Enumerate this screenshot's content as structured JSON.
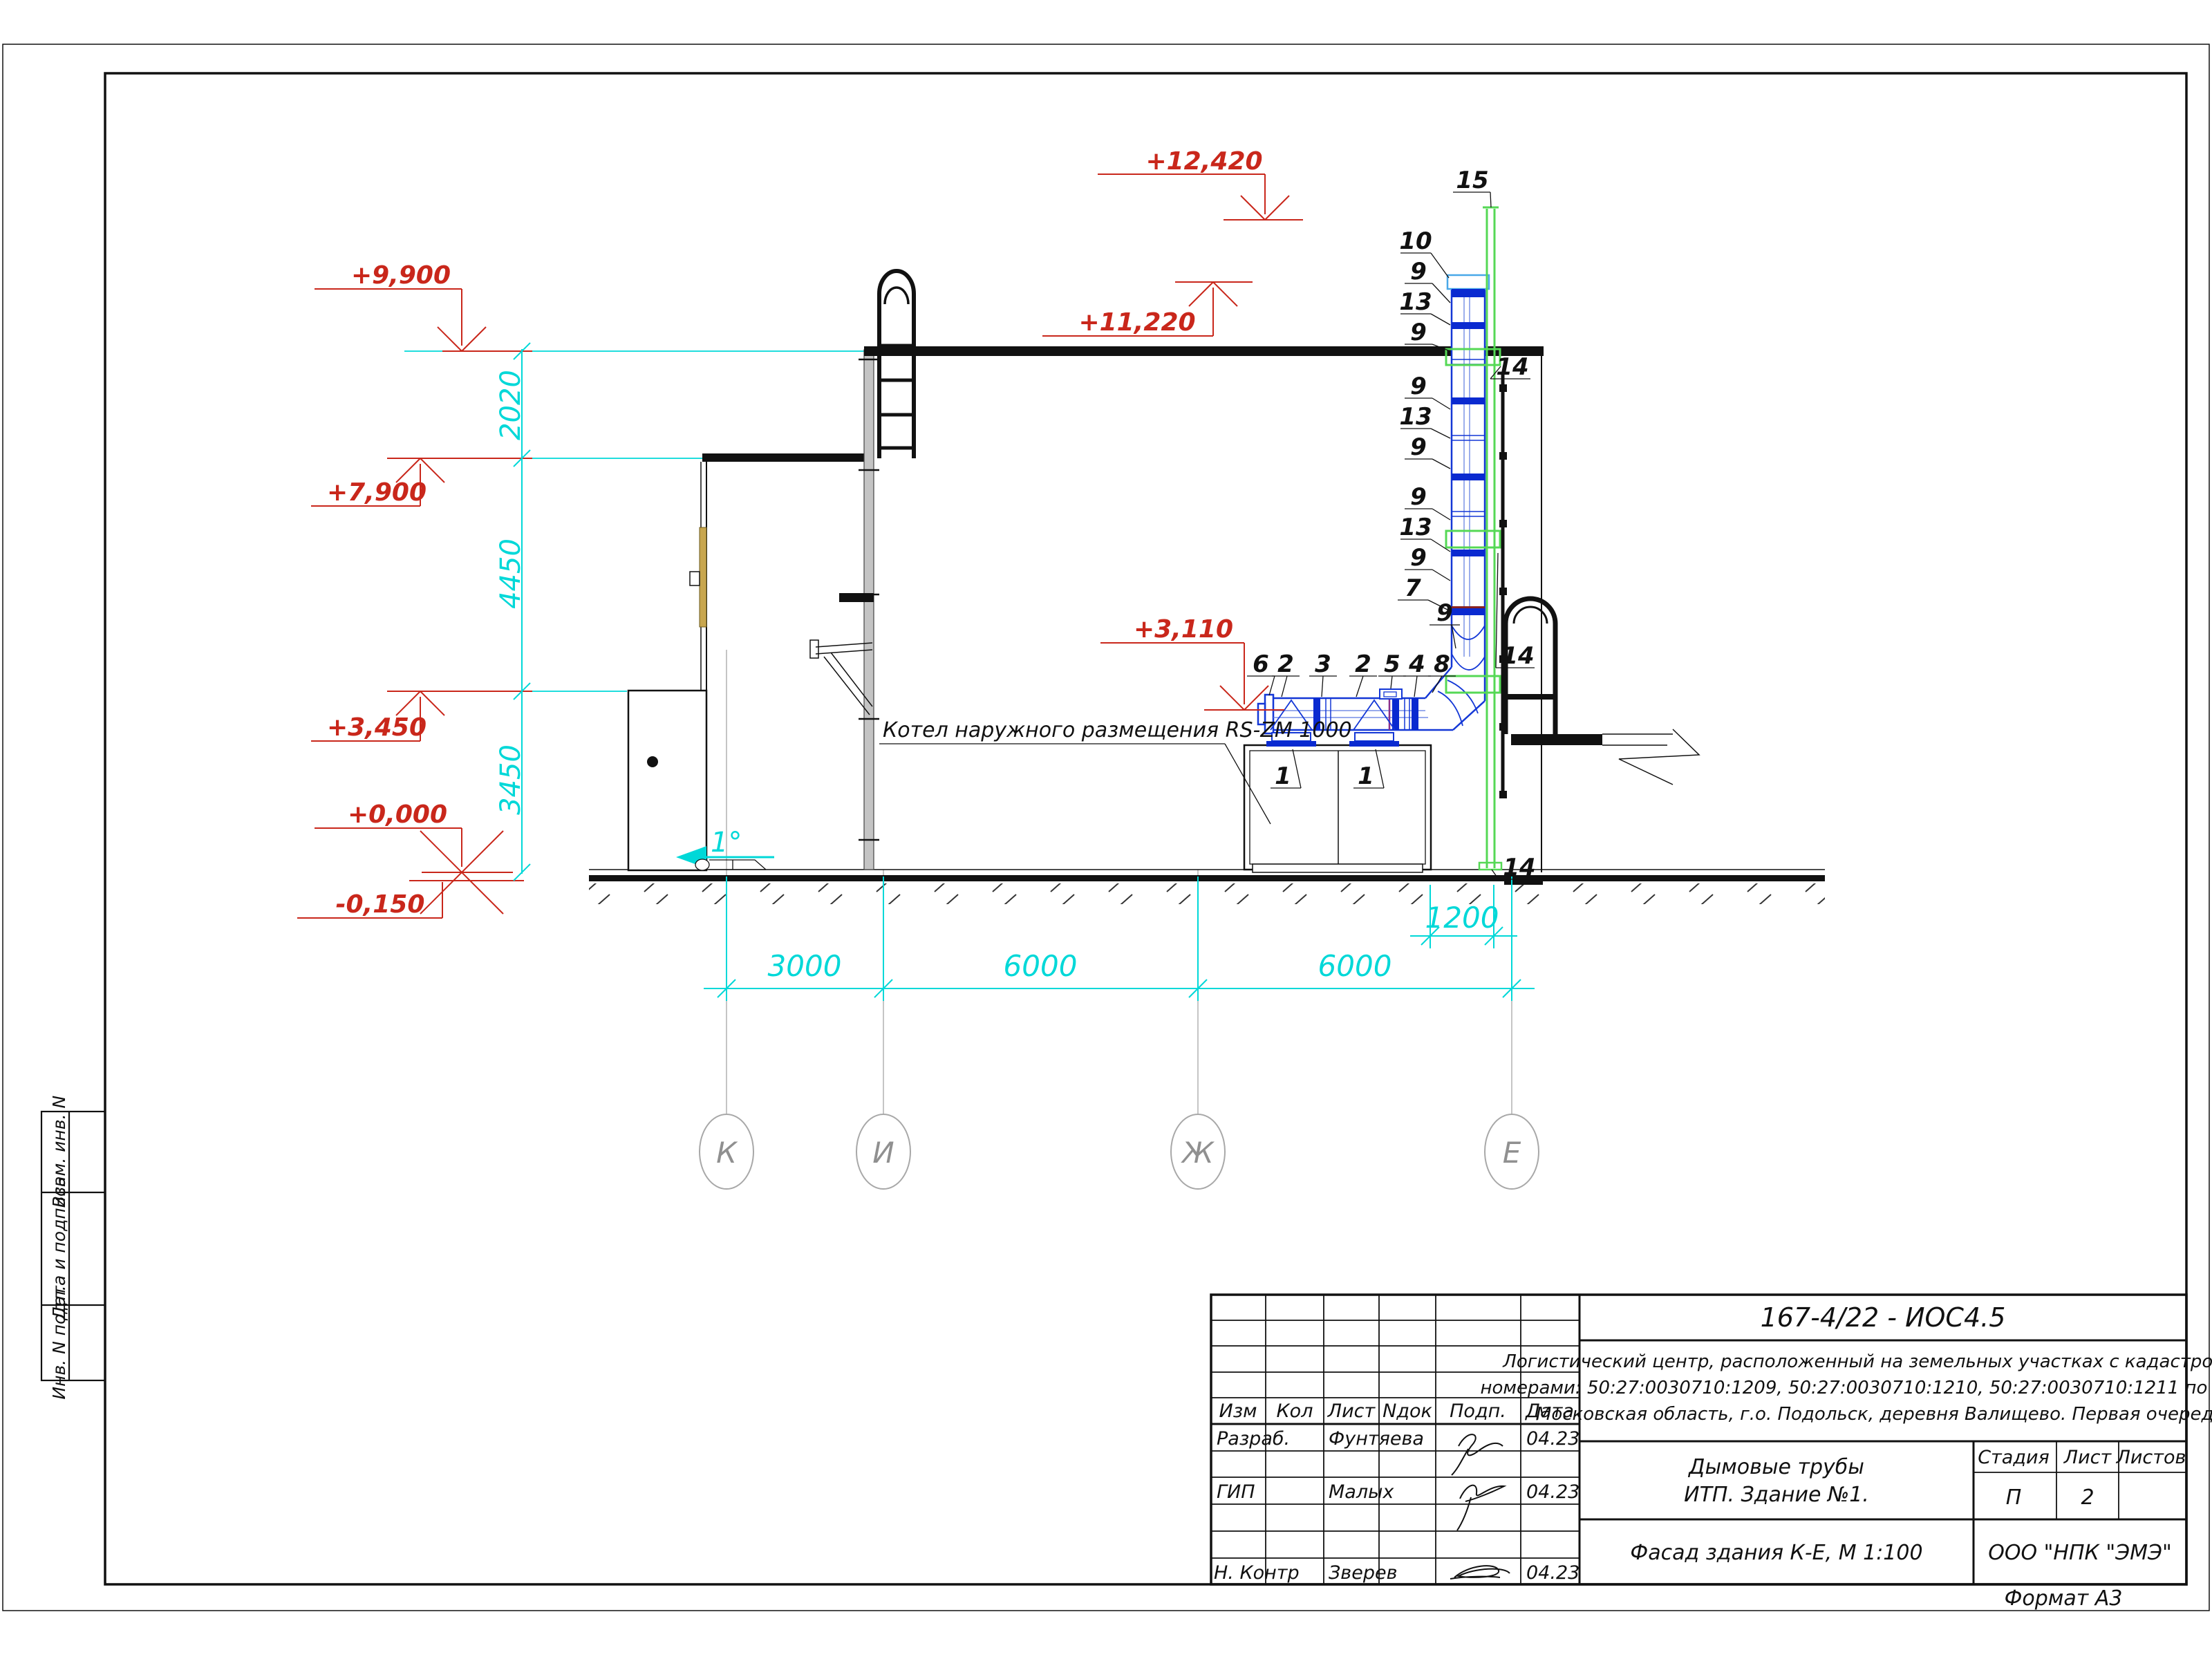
{
  "page": {
    "format_note": "Формат А3"
  },
  "stamp_side": {
    "row1": "Взам. инв. N",
    "row2": "Дата и подпись",
    "row3": "Инв. N подл."
  },
  "title_block": {
    "doc_number": "167-4/22 - ИОС4.5",
    "description_line1": "Логистический центр, расположенный на земельных участках с кадастровыми",
    "description_line2": "номерами: 50:27:0030710:1209, 50:27:0030710:1210, 50:27:0030710:1211 по адресу:",
    "description_line3": "Московская область, г.о. Подольск, деревня Валищево. Первая очередь.",
    "title_line1": "Дымовые трубы",
    "title_line2": "ИТП. Здание №1.",
    "view_title": "Фасад здания К-Е, М 1:100",
    "company": "ООО \"НПК \"ЭМЭ\"",
    "stage_label": "Стадия",
    "sheet_label": "Лист",
    "sheets_label": "Листов",
    "stage": "П",
    "sheet": "2",
    "sheets": "",
    "col_izm": "Изм",
    "col_kol": "Кол",
    "col_list": "Лист",
    "col_ndok": "Nдок",
    "col_podp": "Подп.",
    "col_data": "Дата",
    "row_razrab_role": "Разраб.",
    "row_razrab_name": "Фунтяева",
    "row_razrab_date": "04.23",
    "row_gip_role": "ГИП",
    "row_gip_name": "Малых",
    "row_gip_date": "04.23",
    "row_nkontr_role": "Н. Контр",
    "row_nkontr_name": "Зверев",
    "row_nkontr_date": "04.23"
  },
  "drawing": {
    "note_boiler": "Котел наружного размещения RS-ZM 1000",
    "slope": "1°",
    "elevations": {
      "e12420": "+12,420",
      "e11220": "+11,220",
      "e9900": "+9,900",
      "e7900": "+7,900",
      "e3450": "+3,450",
      "e3110": "+3,110",
      "e0000": "+0,000",
      "em150": "-0,150"
    },
    "dims": {
      "v2020": "2020",
      "v4450": "4450",
      "v3450": "3450",
      "h3000": "3000",
      "h6000a": "6000",
      "h6000b": "6000",
      "h1200": "1200"
    },
    "grid": {
      "k": "К",
      "i": "И",
      "zh": "Ж",
      "e": "Е"
    },
    "parts": {
      "p1": "1",
      "p2": "2",
      "p3": "3",
      "p4": "4",
      "p5": "5",
      "p6": "6",
      "p7": "7",
      "p8": "8",
      "p9": "9",
      "p10": "10",
      "p13": "13",
      "p14": "14",
      "p15": "15"
    }
  }
}
